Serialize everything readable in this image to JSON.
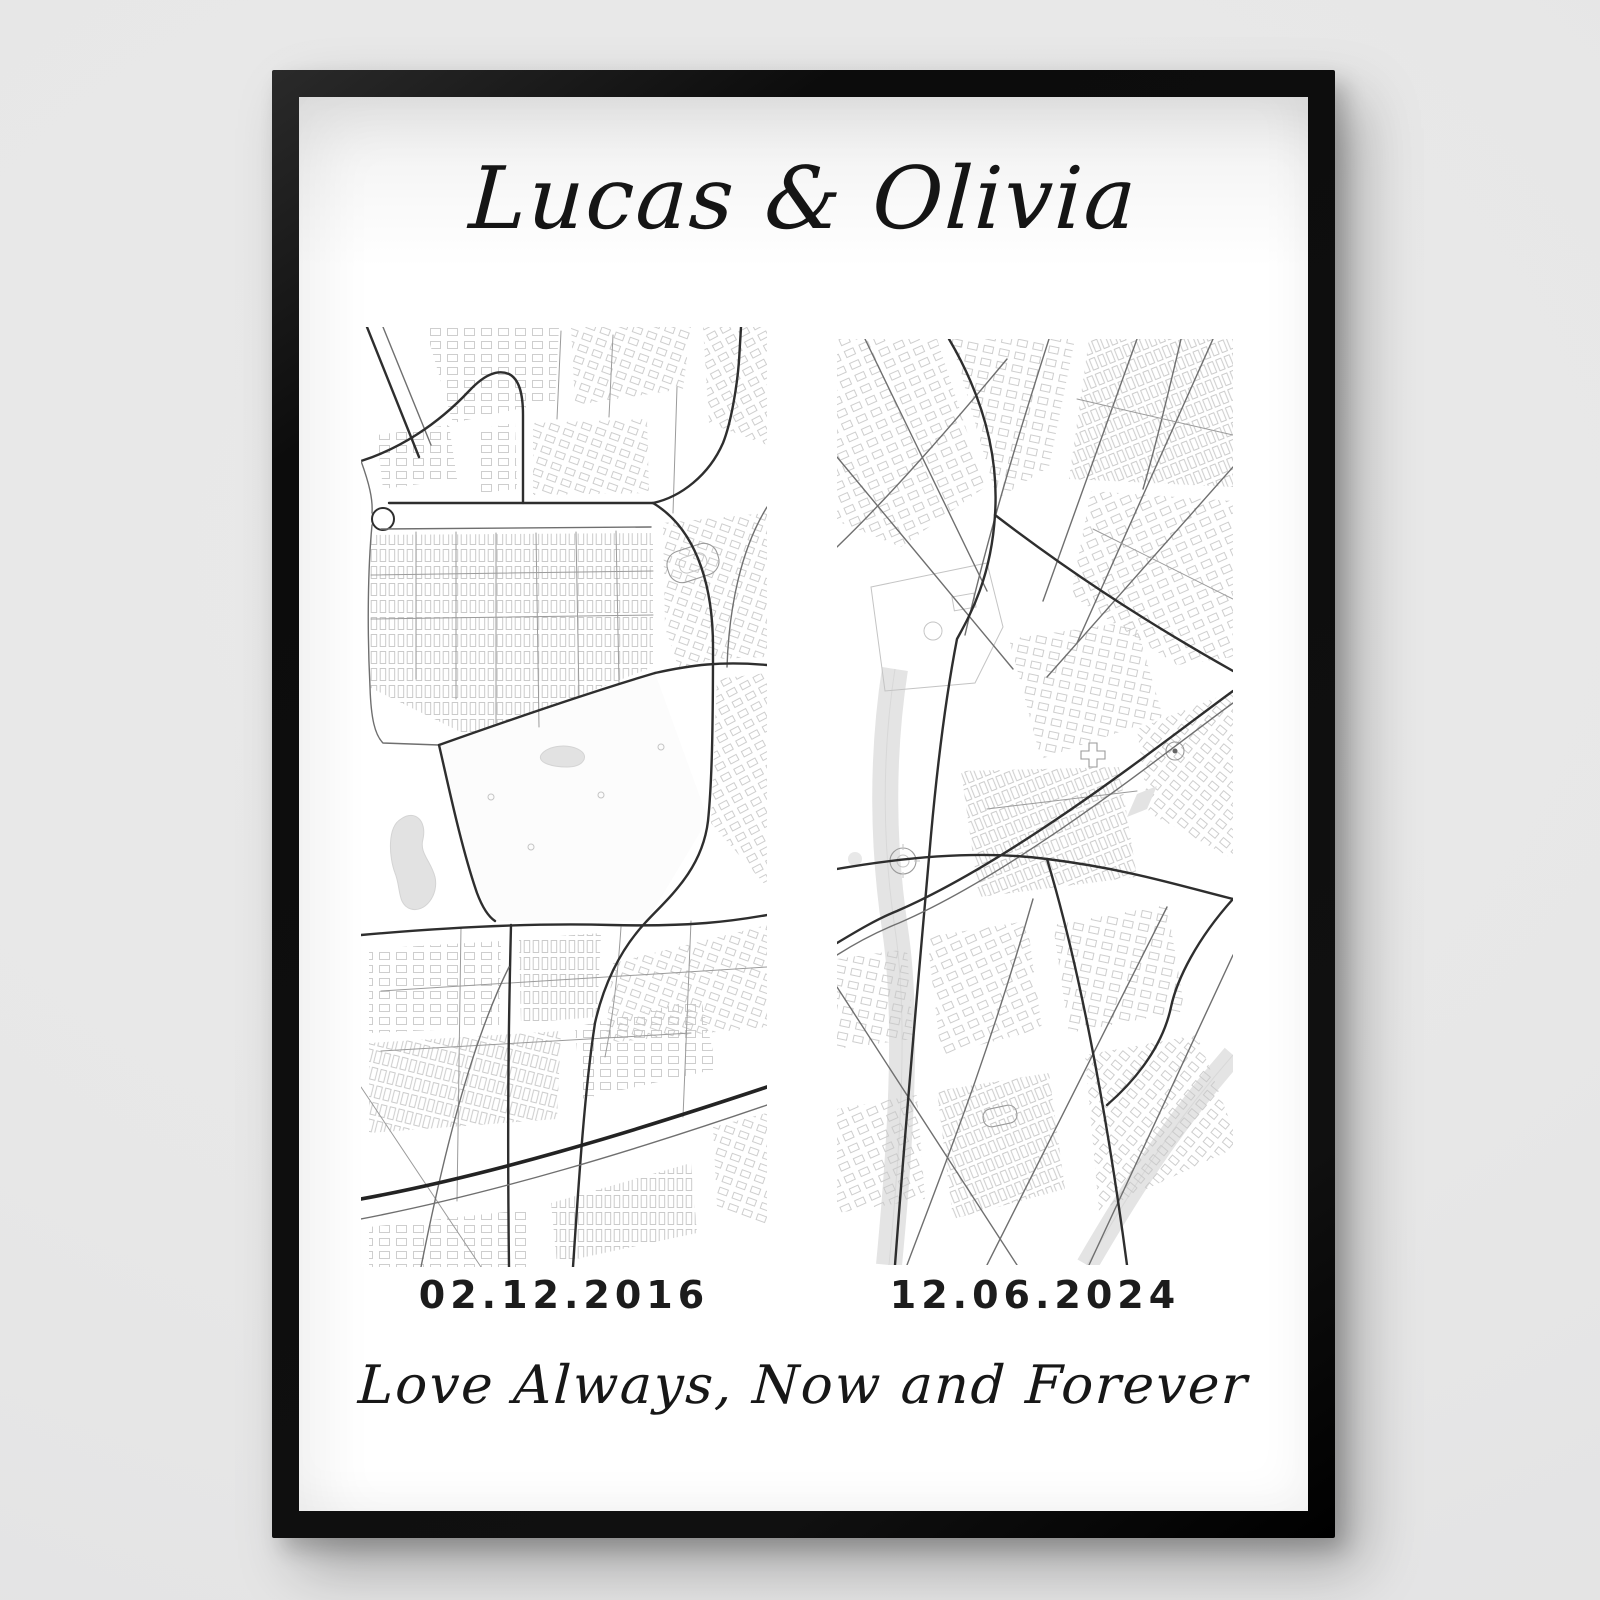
{
  "scene": {
    "wall_color": "#e7e7e7",
    "frame_color": "#101010"
  },
  "poster": {
    "title": "Lucas & Olivia",
    "caption": "Love Always, Now and Forever",
    "panels": [
      {
        "position": "left",
        "date": "02.12.2016"
      },
      {
        "position": "right",
        "date": "12.06.2024"
      }
    ],
    "map_style": {
      "background": "#ffffff",
      "building_outline": "#c9c9c9",
      "minor_road": "#9b9b9b",
      "major_road": "#2e2e2e",
      "water": "#e2e2e2"
    }
  }
}
